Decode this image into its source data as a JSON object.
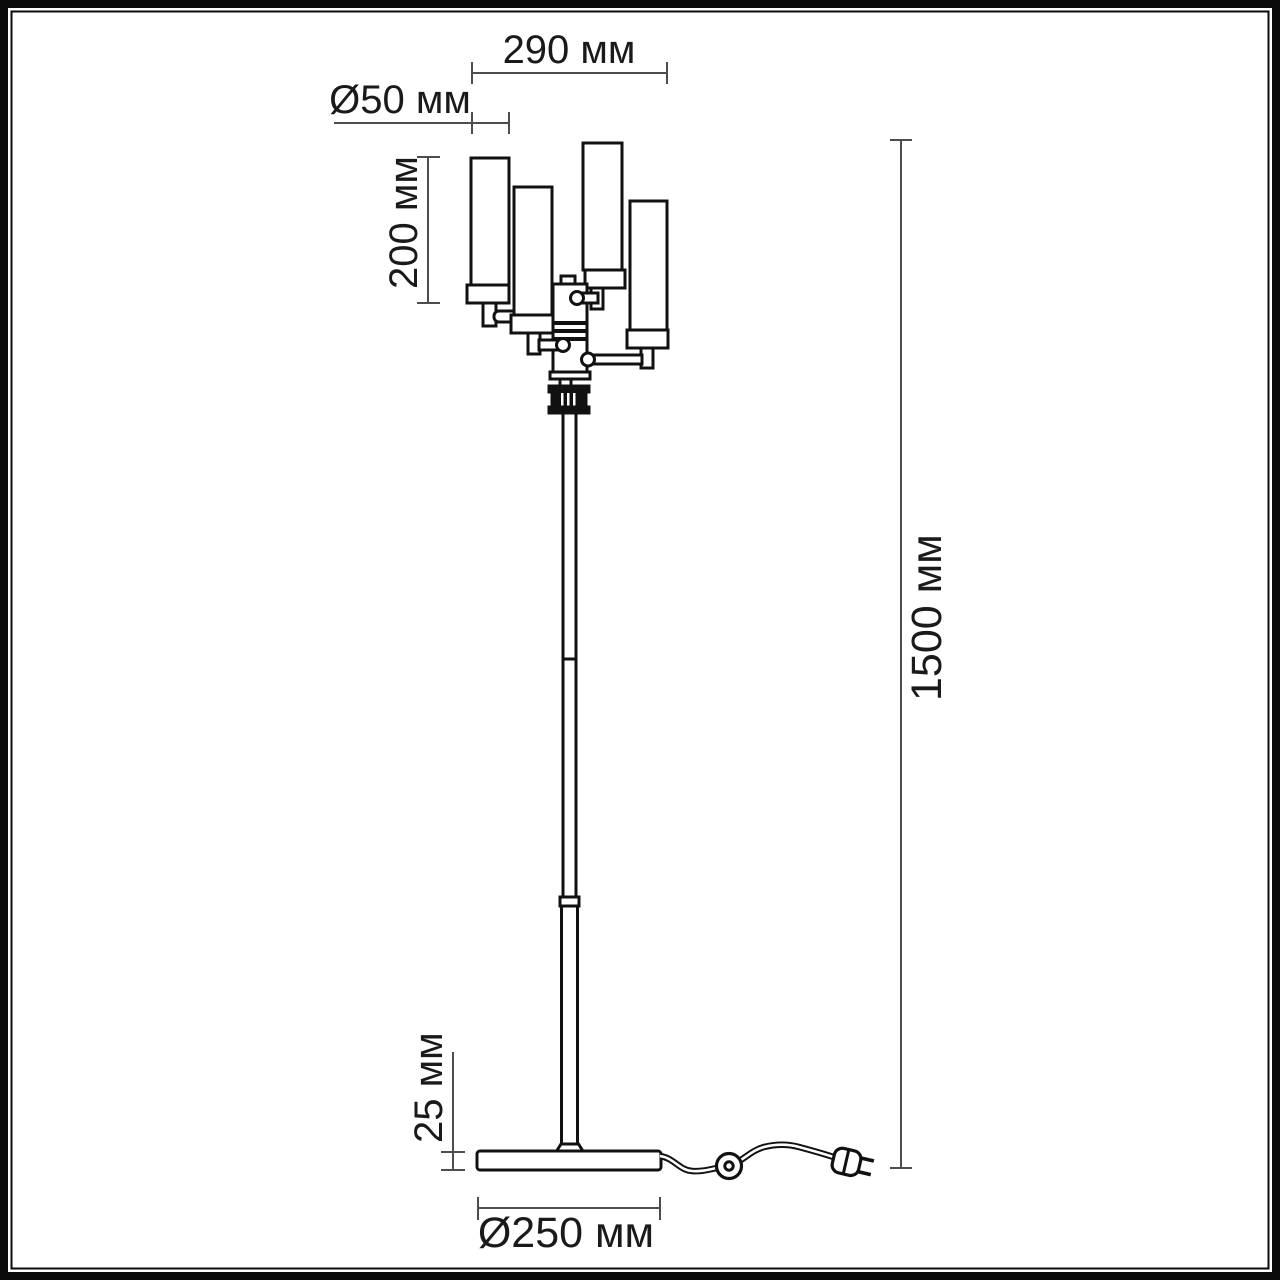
{
  "drawing": {
    "object": "floor-lamp-dimension-drawing",
    "unit_suffix": "мм",
    "labels": {
      "head_width": "290 мм",
      "shade_diameter": "Ø50 мм",
      "shade_height": "200 мм",
      "total_height": "1500 мм",
      "base_thickness": "25 мм",
      "base_diameter": "Ø250 мм"
    },
    "colors": {
      "outline": "#111111",
      "dimension_line": "#4d4d4d",
      "text": "#1a1a1a",
      "fill": "#ffffff",
      "connector_fill": "#111111"
    }
  }
}
